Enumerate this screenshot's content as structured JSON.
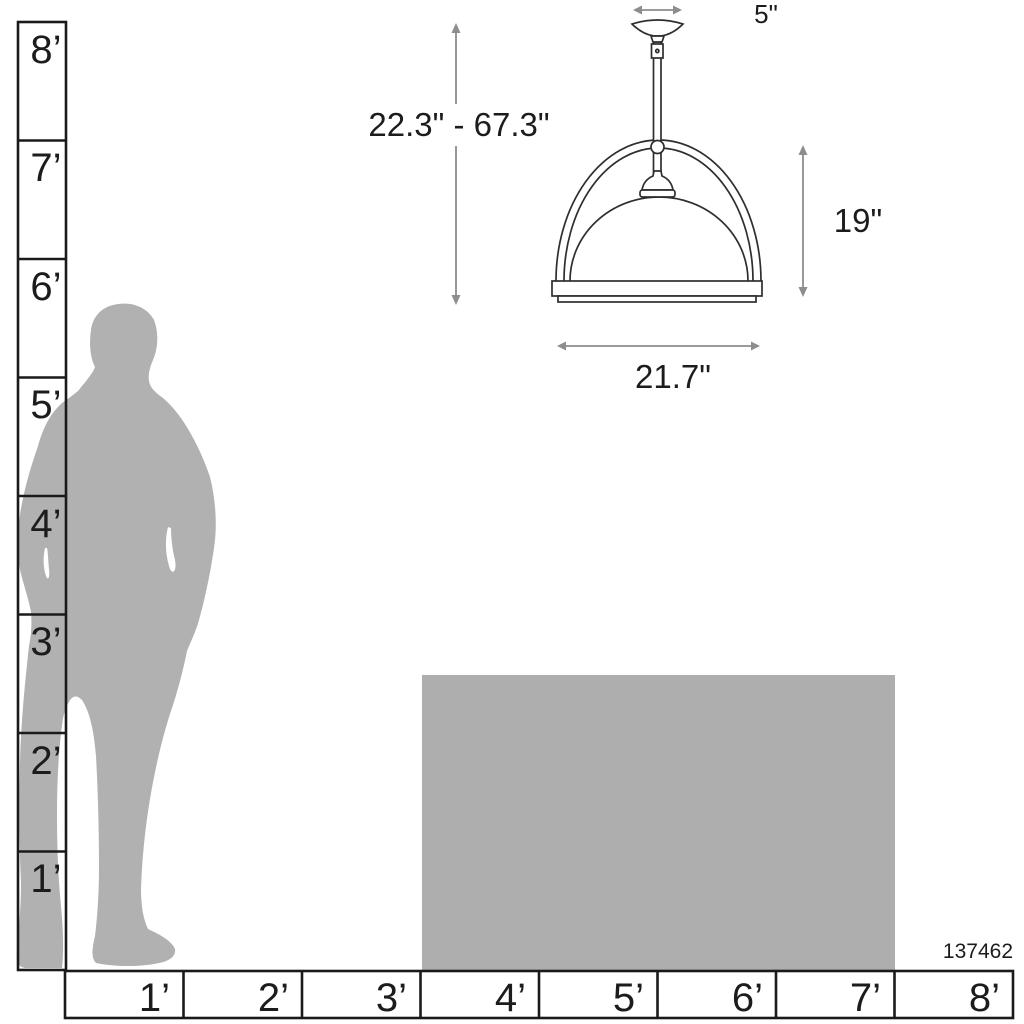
{
  "title": "Pendant light size comparison diagram",
  "product": {
    "id": "137462"
  },
  "pendant_dimensions": {
    "canopy_width": "5\"",
    "overall_height_range": "22.3\" - 67.3\"",
    "fixture_height": "19\"",
    "fixture_width": "21.7\""
  },
  "vertical_ruler": {
    "unit": "feet",
    "labels": [
      "8’",
      "7’",
      "6’",
      "5’",
      "4’",
      "3’",
      "2’",
      "1’"
    ]
  },
  "horizontal_ruler": {
    "unit": "feet",
    "labels": [
      "1’",
      "2’",
      "3’",
      "4’",
      "5’",
      "6’",
      "7’",
      "8’"
    ]
  },
  "reference_objects": {
    "person": "standing man silhouette, approx 5.5 ft tall",
    "table": "rectangle approx 4 ft wide x 2.5 ft tall"
  },
  "colors": {
    "silhouette": "#b1b1b1",
    "table": "#aeaeae",
    "outline": "#2e2e2e",
    "ruler_line": "#1a1a1a",
    "dimension": "#8d8d8d",
    "text": "#1c1c1c",
    "background": "#ffffff"
  }
}
